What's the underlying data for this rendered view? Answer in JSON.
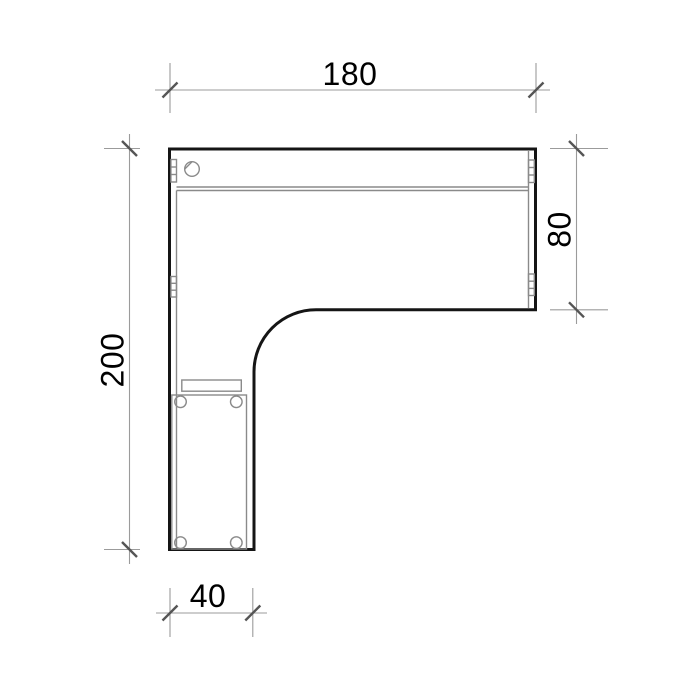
{
  "drawing": {
    "object": "l-shaped-corner-desk-plan-view",
    "dimensions": {
      "top": {
        "label": "180",
        "orientation": "horizontal"
      },
      "right": {
        "label": "80",
        "orientation": "vertical"
      },
      "left": {
        "label": "200",
        "orientation": "vertical"
      },
      "bottom": {
        "label": "40",
        "orientation": "horizontal"
      }
    },
    "parts": [
      "desk-outline",
      "cable-grommet",
      "edge-trim-double-line",
      "hinge-plates",
      "pedestal-unit",
      "drawer-front",
      "casters"
    ]
  },
  "colors": {
    "outline": "#151515",
    "detail": "#8a8a8a",
    "dim_line": "#9b9b9b",
    "tick": "#555555",
    "text": "#000000"
  }
}
